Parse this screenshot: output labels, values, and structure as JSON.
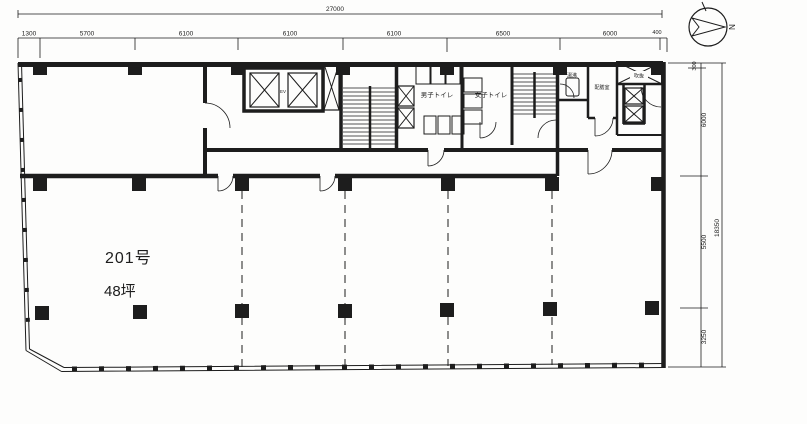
{
  "drawing_type": "floor-plan",
  "colors": {
    "paper": "#fdfdfc",
    "ink": "#1d1d1d"
  },
  "compass": {
    "north": "N"
  },
  "dims": {
    "top": {
      "total": "27000",
      "segments": [
        "1300",
        "5700",
        "6100",
        "6100",
        "6100",
        "6500",
        "6000",
        "400"
      ]
    },
    "right": {
      "total": "18350",
      "segments": [
        "300",
        "6000",
        "5500",
        "3250"
      ]
    }
  },
  "rooms": {
    "main": {
      "number": "201号",
      "area": "48坪"
    },
    "core": {
      "elevator": "EV",
      "mens_toilet": "男子トイレ",
      "womens_toilet": "女子トイレ",
      "kettle": "湯沸",
      "pantry": "配膳室",
      "void": "吹抜"
    }
  }
}
